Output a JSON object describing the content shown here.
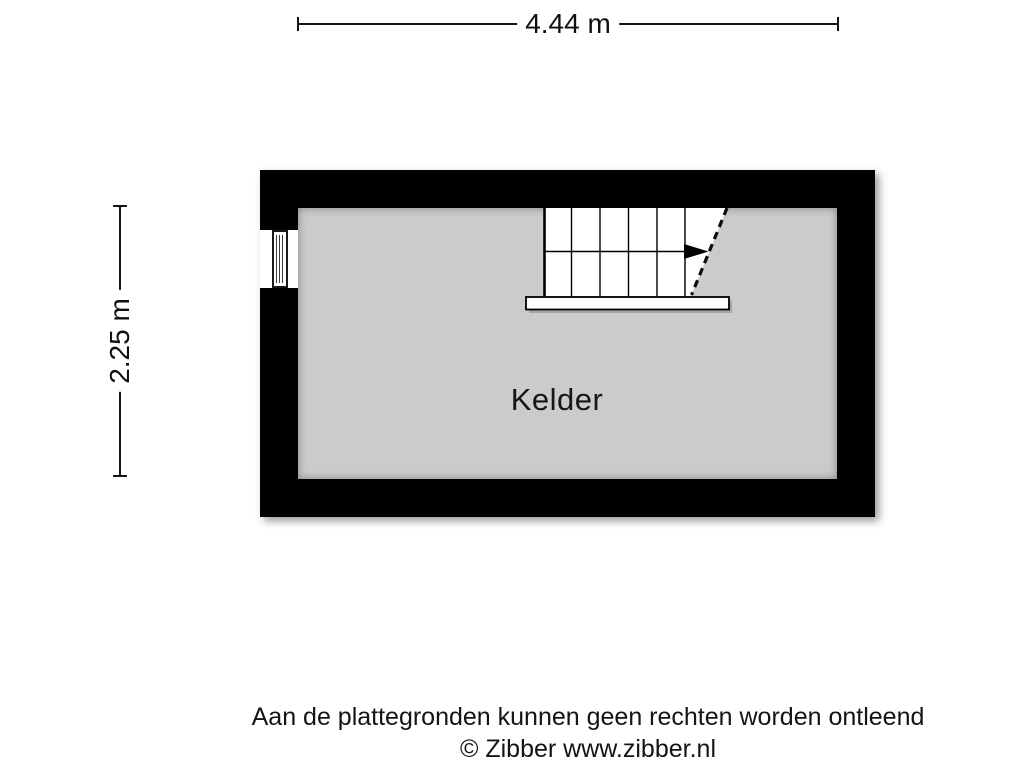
{
  "dimensions": {
    "width_label": "4.44 m",
    "height_label": "2.25 m"
  },
  "floorplan": {
    "room_label": "Kelder",
    "features": [
      "staircase",
      "window"
    ],
    "stair_direction": "right",
    "wall_color": "#000000",
    "floor_color": "#cbcbcb"
  },
  "footer": {
    "disclaimer": "Aan de plattegronden kunnen geen rechten worden ontleend",
    "copyright": "© Zibber www.zibber.nl"
  }
}
